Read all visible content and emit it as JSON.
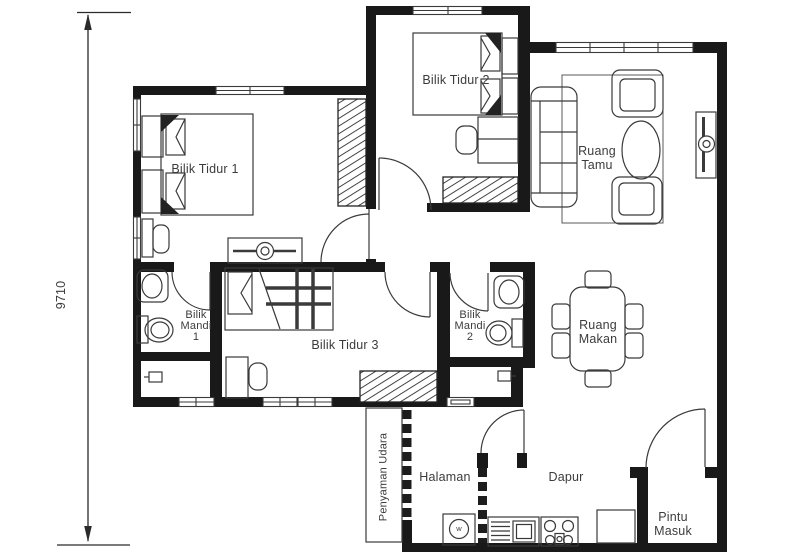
{
  "title": "Pelan Lantai Rumah",
  "dimension": {
    "value": "9710"
  },
  "rooms": {
    "bilik_tidur_1": {
      "label": "Bilik Tidur 1"
    },
    "bilik_tidur_2": {
      "label": "Bilik Tidur 2"
    },
    "bilik_tidur_3": {
      "label": "Bilik Tidur 3"
    },
    "bilik_mandi_1": {
      "label": "Bilik\nMandi\n1"
    },
    "bilik_mandi_2": {
      "label": "Bilik\nMandi\n2"
    },
    "ruang_tamu": {
      "label": "Ruang\nTamu"
    },
    "ruang_makan": {
      "label": "Ruang\nMakan"
    },
    "dapur": {
      "label": "Dapur"
    },
    "halaman": {
      "label": "Halaman"
    },
    "pintu_masuk": {
      "label": "Pintu\nMasuk"
    },
    "penyaman_udara": {
      "label": "Penyaman Udara"
    }
  },
  "appliances": {
    "washer_letter": "w"
  },
  "icons": {
    "double_bed": "bed-with-pillows-icon",
    "single_bed": "plaid-bed-icon",
    "wardrobe": "hatched-wardrobe-icon",
    "dresser": "dresser-round-mirror-icon",
    "sofa_set": "sofa-armchairs-oval-table-icon",
    "tv_console": "tv-unit-icon",
    "dining_set": "table-six-chairs-icon",
    "toilet": "tank-bowl-toilet-icon",
    "wash_basin": "oval-basin-icon",
    "washing_machine": "circle-drum-icon",
    "kitchen_sink": "basin-dish-rack-icon",
    "stove": "four-burner-icon",
    "door": "quarter-arc-swing-icon",
    "window": "triple-line-window-icon"
  },
  "colors": {
    "wall": "#191919",
    "line": "#3a3a3a",
    "text": "#3c3c3c",
    "bg": "#ffffff"
  }
}
